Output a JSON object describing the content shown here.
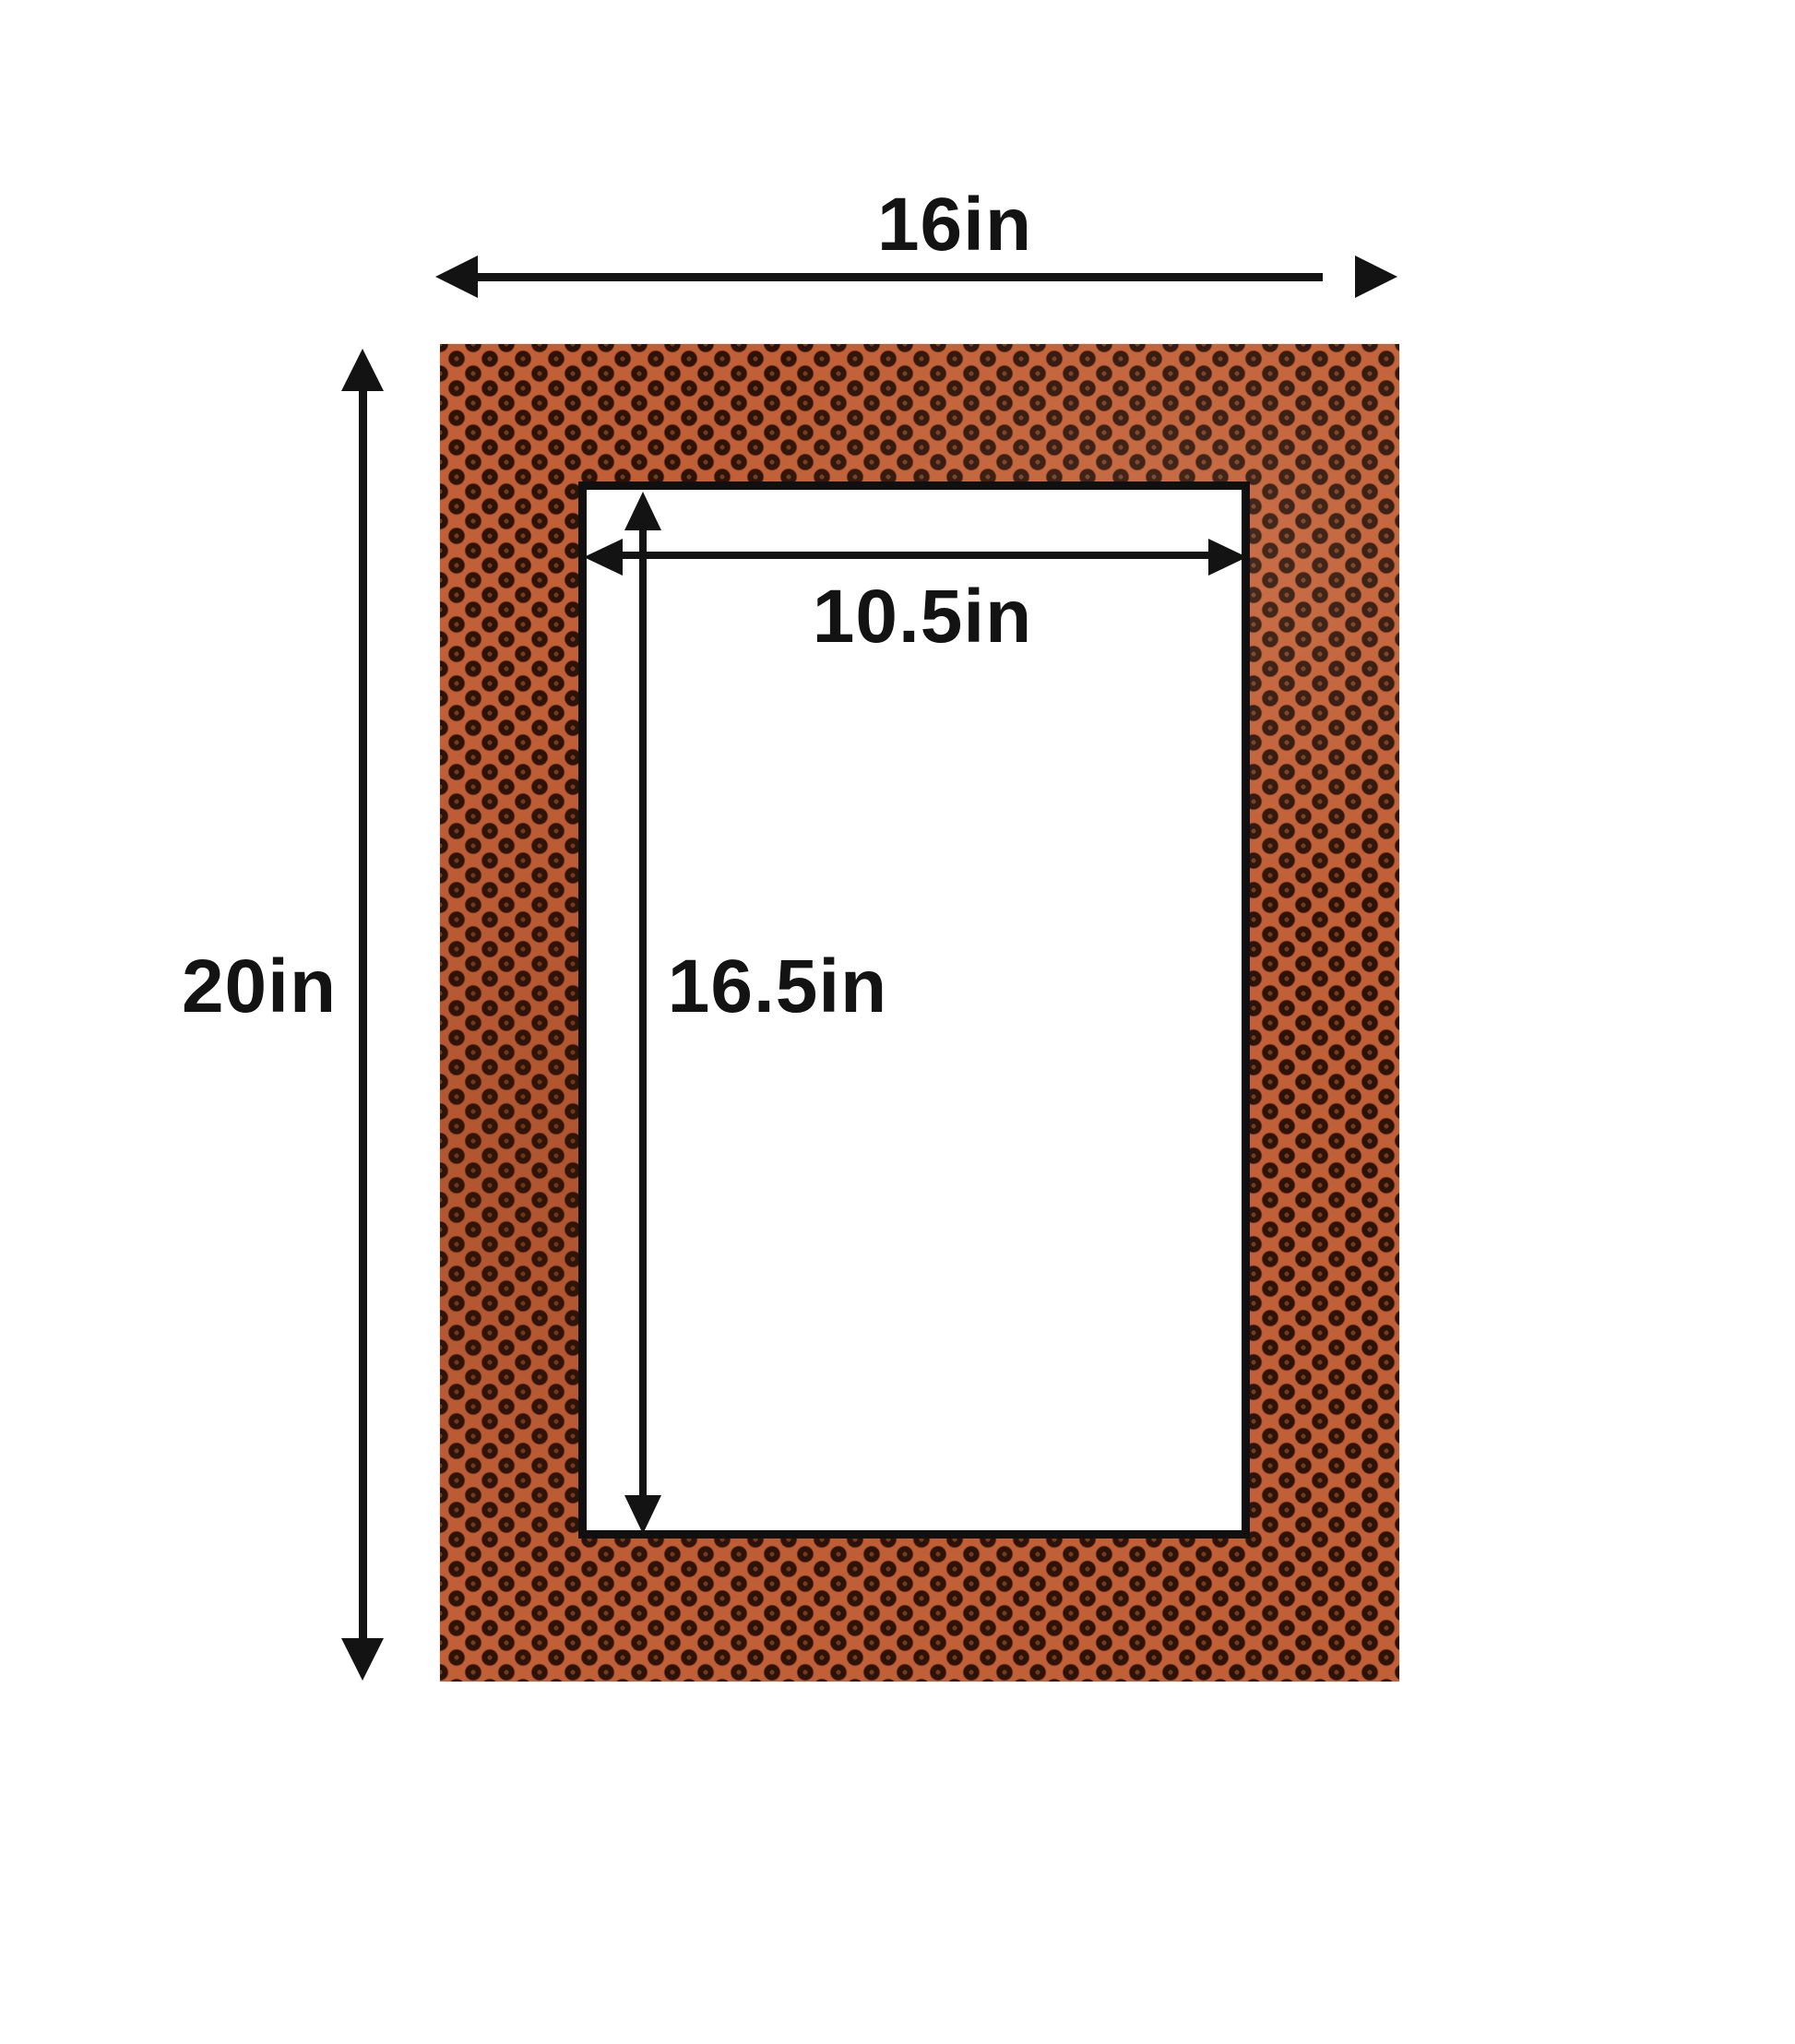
{
  "diagram": {
    "type": "picture-mat-dimension-diagram"
  },
  "labels": {
    "outer_width": "16in",
    "outer_height": "20in",
    "opening_width": "10.5in",
    "opening_height": "16.5in"
  },
  "dimensions": {
    "outer": {
      "width_in": 16,
      "height_in": 20
    },
    "opening": {
      "width_in": 10.5,
      "height_in": 16.5
    }
  },
  "colors": {
    "background": "#ffffff",
    "mat_base": "#c15f36",
    "mat_dot": "#2e1208",
    "mat_dot_center": "#6e3d1e",
    "opening_fill": "#ffffff",
    "opening_border": "#101010",
    "annotation": "#131313"
  }
}
